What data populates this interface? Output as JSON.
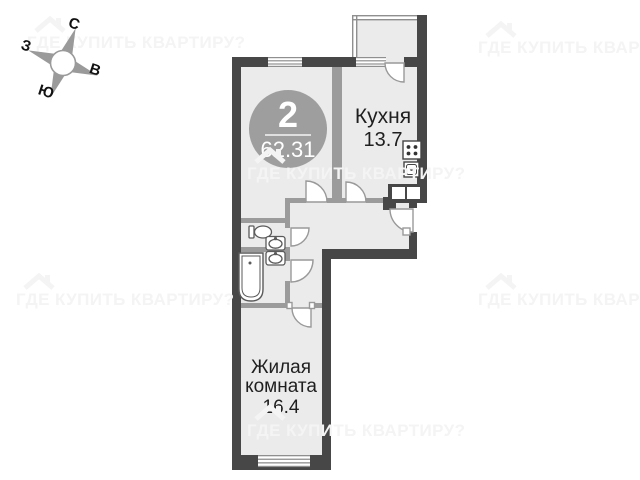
{
  "compass": {
    "north": "С",
    "west": "З",
    "east": "В",
    "south": "Ю"
  },
  "badge": {
    "room_count": "2",
    "total_area": "62.31"
  },
  "rooms": {
    "kitchen": {
      "name": "Кухня",
      "area": "13.7"
    },
    "living_room": {
      "name": "Жилая комната",
      "area": "16.4"
    }
  },
  "watermark": {
    "text": "ГДЕ КУПИТЬ КВАРТИРУ?"
  },
  "colors": {
    "outer_wall": "#474747",
    "inner_wall": "#9b9b9b",
    "floor": "#ebebeb",
    "badge_circle": "#9e9e9e",
    "watermark": "#f4f4f4"
  }
}
